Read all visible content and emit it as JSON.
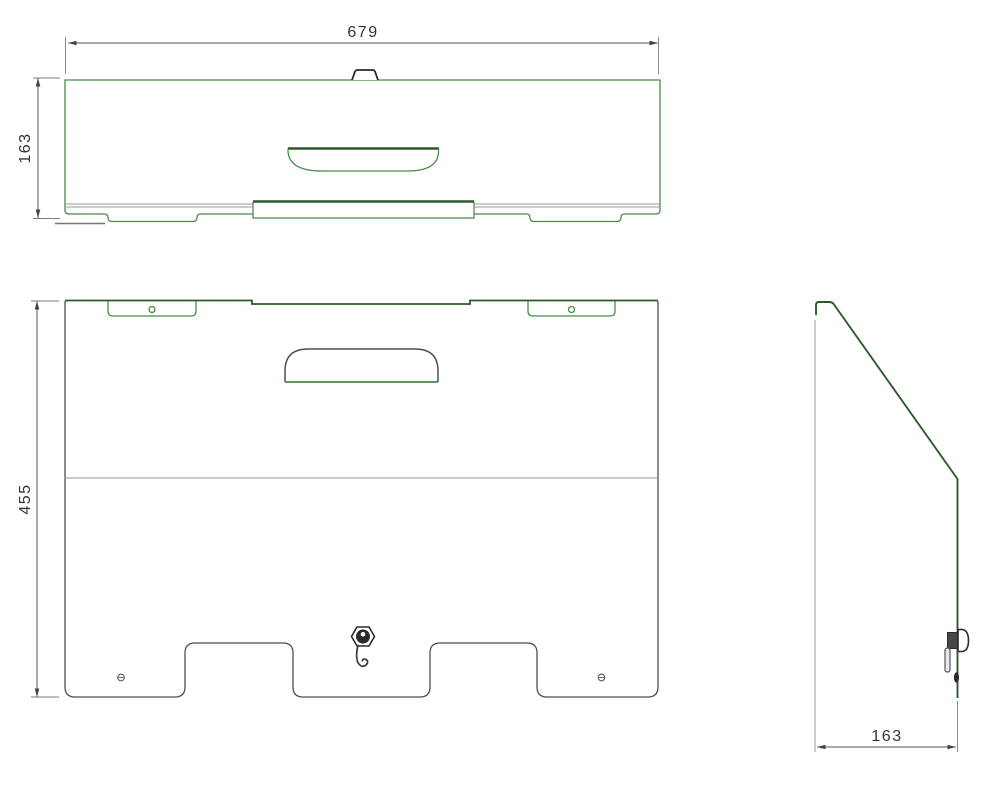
{
  "drawing": {
    "views": {
      "top": {
        "width_dim": "679",
        "height_dim": "163"
      },
      "front": {
        "height_dim": "455"
      },
      "side": {
        "depth_dim": "163"
      }
    },
    "colors": {
      "part_outline_green": "#4a8a4a",
      "part_outline_dark_green": "#2d5a2d",
      "part_outline_gray": "#4f4f4f",
      "hidden_line_gray": "#9a9a9a",
      "dimension_line": "#555555",
      "dimension_text": "#333333"
    }
  }
}
